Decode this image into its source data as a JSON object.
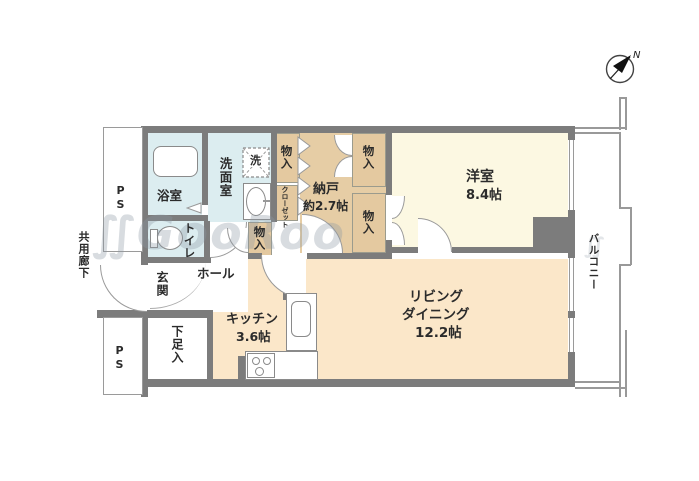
{
  "title": "マンション間取り図",
  "compass": {
    "label": "N"
  },
  "watermark": {
    "symbol": "∬",
    "text": "GooRoo"
  },
  "labels": {
    "corridor": "共用廊下",
    "ps": "PS",
    "balcony": "バルコニー",
    "bathroom": "浴室",
    "washroom": "洗面室",
    "washer": "洗",
    "toilet": "トイレ",
    "storage": "物入",
    "closet": "クローゼット",
    "nando_name": "納戸",
    "nando_size": "約2.7帖",
    "western_name": "洋室",
    "western_size": "8.4帖",
    "hall": "ホール",
    "genkan": "玄関",
    "shoe": "下足入",
    "kitchen_name": "キッチン",
    "kitchen_size": "3.6帖",
    "living_line1": "リビング",
    "living_line2": "ダイニング",
    "living_size": "12.2帖"
  },
  "colors": {
    "wall": "#7c7c7c",
    "thin_line": "#999999",
    "wet_area": "#dcedf0",
    "storage_area": "#e4c9a0",
    "western_room": "#fcf8e2",
    "living_area": "#fbe7c9"
  }
}
